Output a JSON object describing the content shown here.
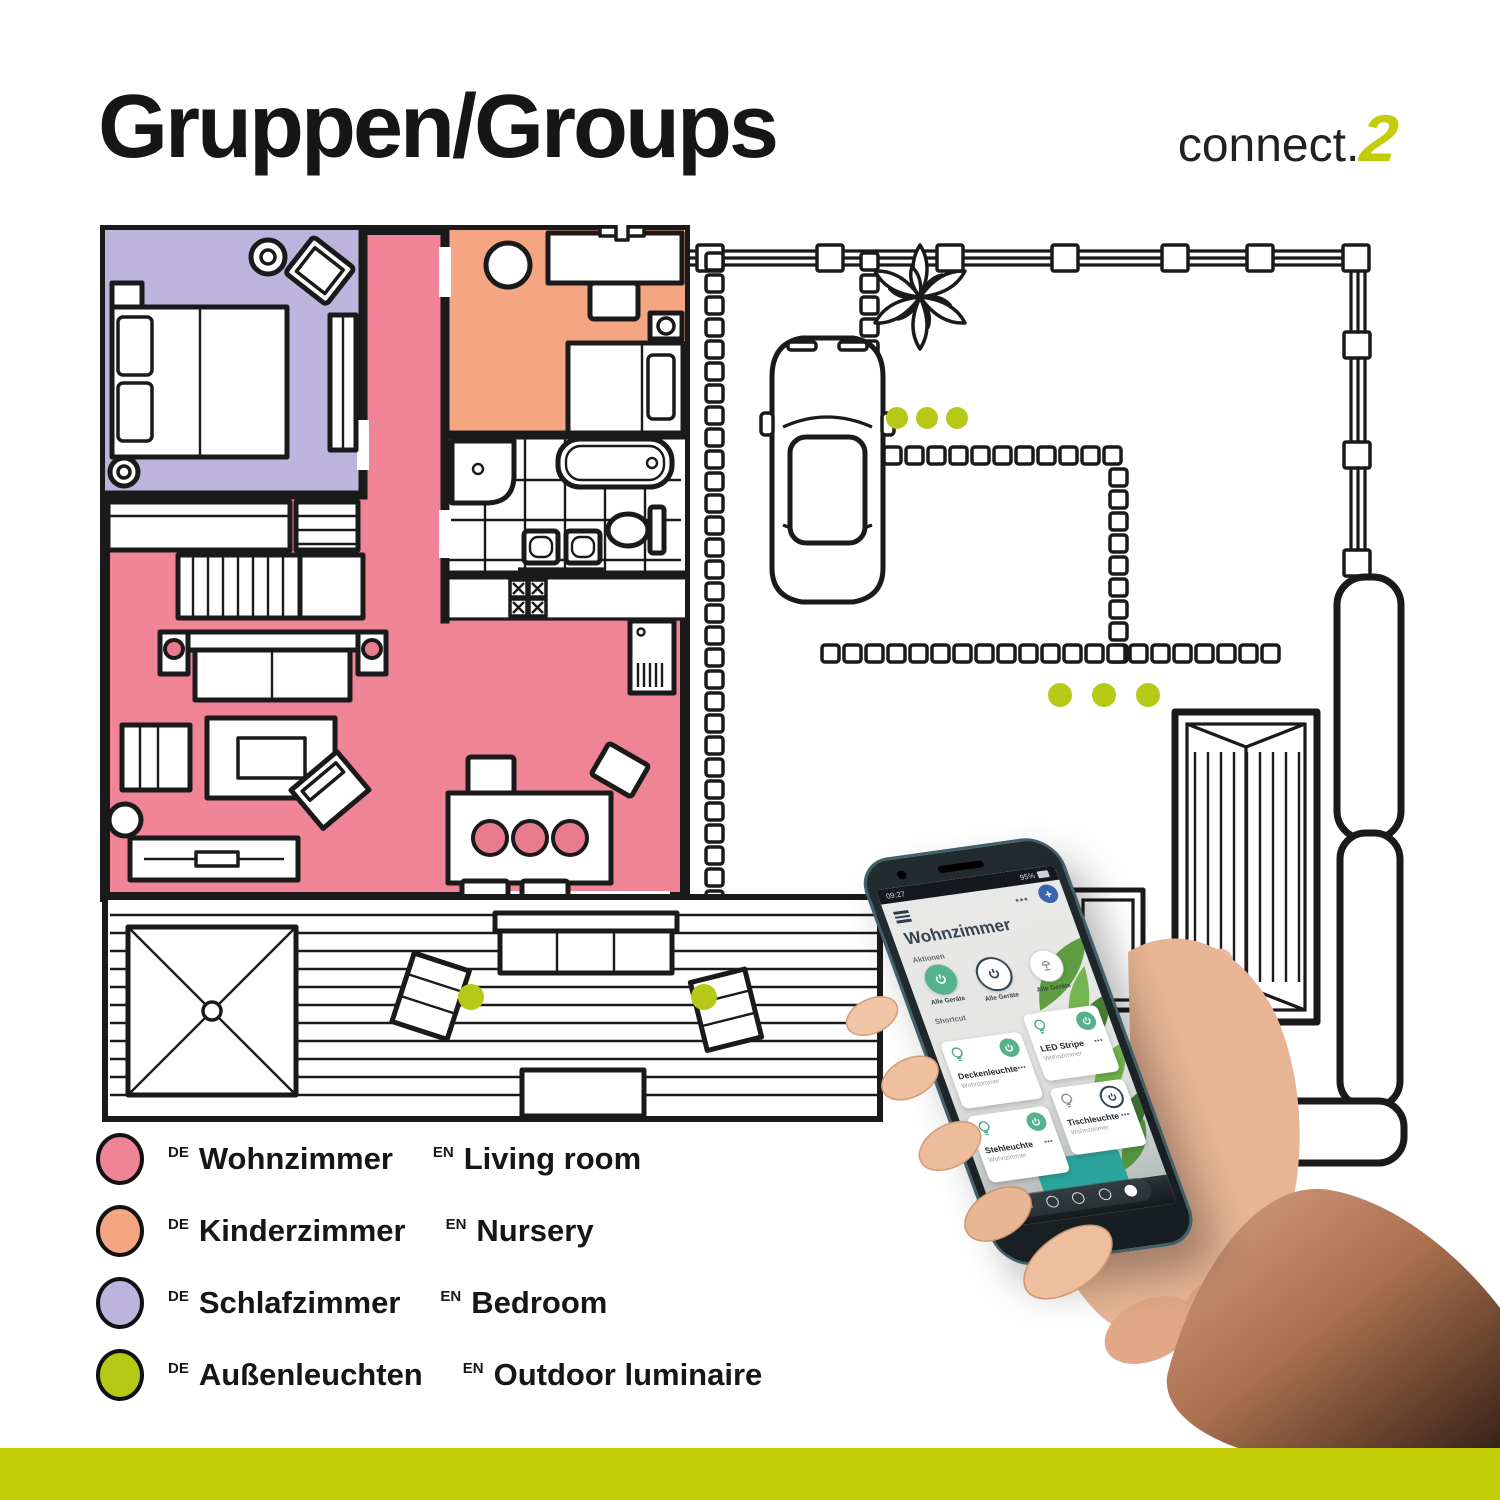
{
  "colors": {
    "pink": "#ef8496",
    "orange": "#f5a582",
    "purple": "#bcb4dd",
    "lime": "#b5c916",
    "lime_bar": "#c3cc05",
    "plate": "#e87b8e",
    "wall": "#1a1a1a",
    "app_green": "#54b28c",
    "app_navy": "#35444f"
  },
  "header": {
    "title": "Gruppen/Groups",
    "logo_text": "connect.",
    "logo_accent": "2"
  },
  "legend": {
    "de_tag": "DE",
    "en_tag": "EN",
    "rows": [
      {
        "de": "Wohnzimmer",
        "en": "Living room",
        "color": "#ef8496"
      },
      {
        "de": "Kinderzimmer",
        "en": "Nursery",
        "color": "#f5a582"
      },
      {
        "de": "Schlafzimmer",
        "en": "Bedroom",
        "color": "#bcb4dd"
      },
      {
        "de": "Außenleuchten",
        "en": "Outdoor luminaire",
        "color": "#b5c916"
      }
    ]
  },
  "phone": {
    "status": {
      "time": "09:27",
      "battery": "95%"
    },
    "toolbar": {
      "more": "•••",
      "add": "+"
    },
    "app": {
      "title": "Wohnzimmer",
      "actions_label": "Aktionen",
      "shortcut_label": "Shortcut",
      "actions": [
        {
          "label": "Alle Geräte",
          "state": "on"
        },
        {
          "label": "Alle Geräte",
          "state": "off"
        },
        {
          "label": "Alle Geräte",
          "state": "lamp"
        }
      ],
      "tiles": [
        {
          "name": "Deckenleuchte",
          "room": "Wohnzimmer",
          "power": "on"
        },
        {
          "name": "LED Stripe",
          "room": "Wohnzimmer",
          "power": "on"
        },
        {
          "name": "Stehleuchte",
          "room": "Wohnzimmer",
          "power": "on"
        },
        {
          "name": "Tischleuchte",
          "room": "Wohnzimmer",
          "power": "off"
        }
      ]
    }
  }
}
